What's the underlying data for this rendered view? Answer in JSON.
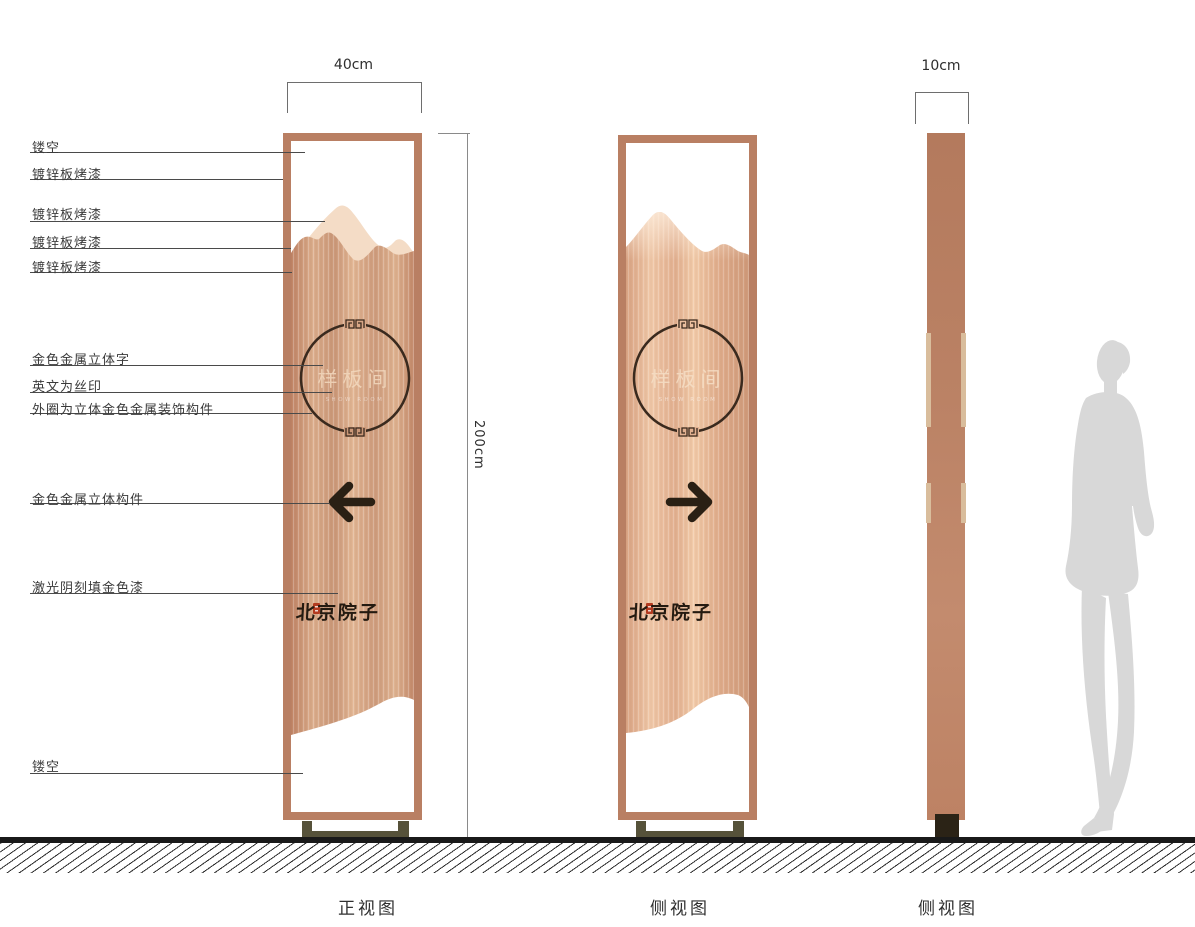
{
  "views": {
    "front_label": "正视图",
    "side_label_1": "侧视图",
    "side_label_2": "侧视图"
  },
  "dimensions": {
    "front_width": "40cm",
    "total_height": "200cm",
    "side_width": "10cm"
  },
  "callouts": [
    "镂空",
    "镀锌板烤漆",
    "镀锌板烤漆",
    "镀锌板烤漆",
    "镀锌板烤漆",
    "金色金属立体字",
    "英文为丝印",
    "外圈为立体金色金属装饰构件",
    "金色金属立体构件",
    "激光阴刻填金色漆",
    "镂空"
  ],
  "signage": {
    "room_name": "样板间",
    "room_name_en": "SHOW ROOM",
    "brand_name": "北京院子"
  },
  "icons": {
    "front_arrow": "arrow-left",
    "side_arrow": "arrow-right",
    "brand_seal": "red-seal",
    "scale_figure": "human-silhouette"
  },
  "colors": {
    "copper_frame": "#b97f63",
    "copper_panel_mid": "#d19d7e",
    "copper_mountain_light": "#f4dcc6",
    "base_olive": "#56523a",
    "foot_dark": "#2b2316",
    "seal_red": "#b33b20",
    "silhouette_gray": "#d8d8d8",
    "ink_dark": "#2a2014"
  }
}
